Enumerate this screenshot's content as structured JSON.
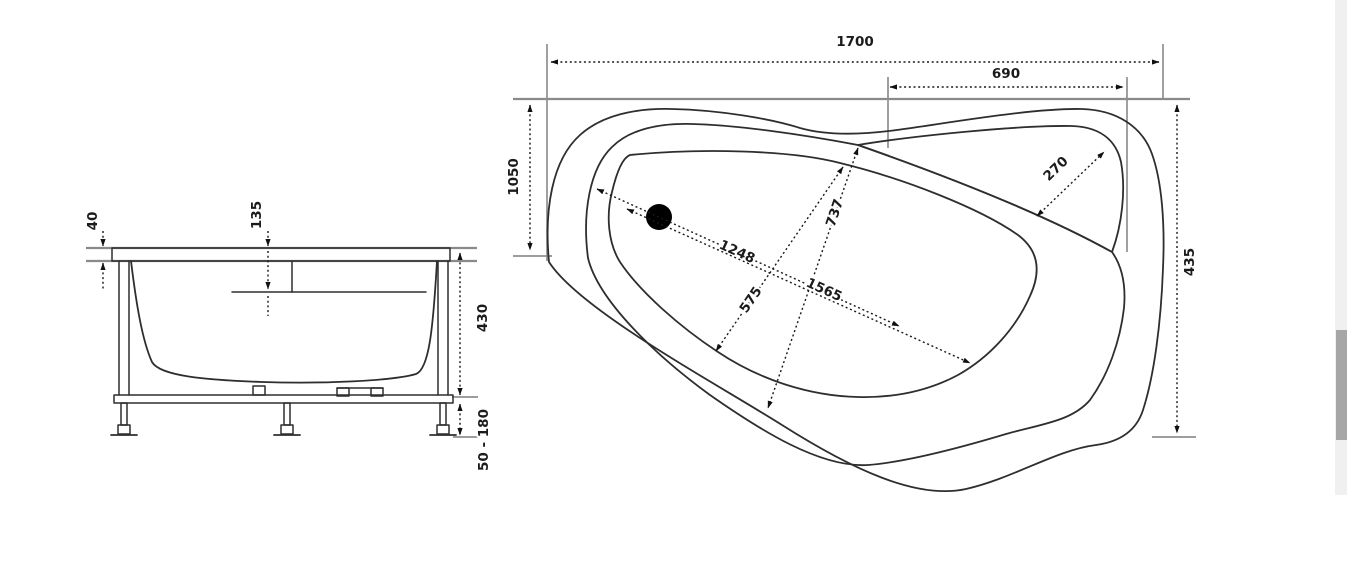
{
  "diagram": {
    "kind": "bathtub-technical-drawing",
    "units": "mm",
    "front_view": {
      "labels": {
        "rim_height": "40",
        "overflow_depth": "135",
        "tub_depth": "430",
        "feet_range": "50 - 180"
      }
    },
    "plan_view": {
      "labels": {
        "overall_length": "1700",
        "corner_shelf_width": "690",
        "left_side_width": "1050",
        "right_side_width": "435",
        "headrest_depth": "270",
        "inner_width": "737",
        "floor_width": "575",
        "floor_length": "1248",
        "inner_length": "1565"
      },
      "drain": "drain-hole"
    },
    "colors": {
      "line": "#2e2e2e",
      "reference_line": "#8f8f8f",
      "scrollbar_track": "#f0f0f1",
      "scrollbar_thumb": "#a6a6a6"
    }
  }
}
